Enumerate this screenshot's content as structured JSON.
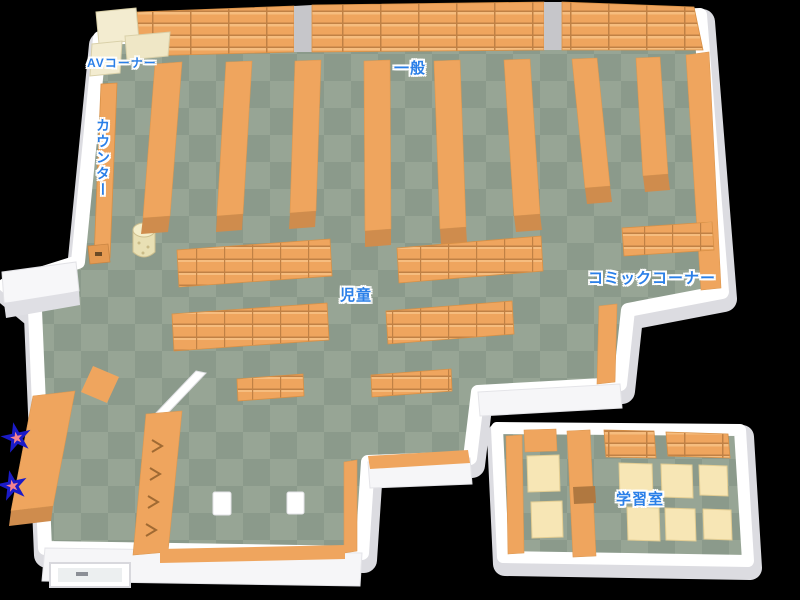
{
  "map": {
    "name": "library-floor-map",
    "areas": [
      {
        "id": "av-corner",
        "label": "AVコーナー"
      },
      {
        "id": "counter",
        "label": "カウンター"
      },
      {
        "id": "general",
        "label": "一般"
      },
      {
        "id": "children",
        "label": "児童"
      },
      {
        "id": "comic-corner",
        "label": "コミックコーナー"
      },
      {
        "id": "study-room",
        "label": "学習室"
      }
    ],
    "markers": [
      {
        "id": "star-1",
        "icon": "star-icon",
        "glyph": "★"
      },
      {
        "id": "star-2",
        "icon": "star-icon",
        "glyph": "★"
      }
    ],
    "colors": {
      "background": "#000000",
      "floor_light": "#97a595",
      "floor_dark": "#8b9a8b",
      "shelf": "#efa55e",
      "shelf_side": "#cf8c4d",
      "shelf_line": "#bd8045",
      "shelf_highlight": "#f6bd7f",
      "av_shelf_cream": "#f3ecd0",
      "table_cream": "#f7e6b5",
      "wall": "#ffffff",
      "wall_shade": "#dcdce1",
      "label_blue": "#2a7fe8",
      "label_outline": "#ffffff",
      "star_pink": "#f4838e",
      "star_outline": "#1b1bc8",
      "door_gap_gray": "#c6c6ca"
    }
  }
}
